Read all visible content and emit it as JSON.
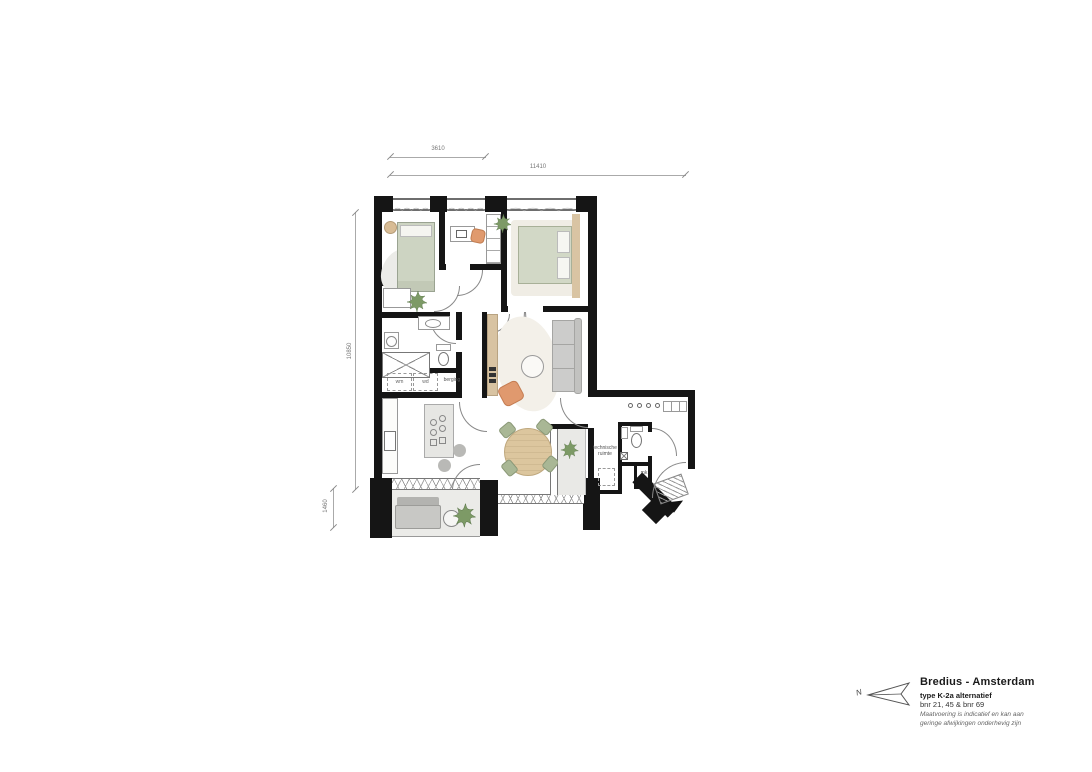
{
  "dimensions": {
    "top_inner": "3610",
    "top_outer": "11410",
    "left_outer": "10850",
    "left_lower": "1460"
  },
  "room_labels": {
    "storage": "berging",
    "washer": "wm",
    "dryer": "wd",
    "technical_line1": "technische",
    "technical_line2": "ruimte",
    "meter_closet": "mk"
  },
  "title_block": {
    "project": "Bredius - Amsterdam",
    "plan_type": "type K-2a alternatief",
    "units": "bnr 21, 45 & bnr 69",
    "disclaimer_line1": "Maatvoering is indicatief en kan aan",
    "disclaimer_line2": "geringe afwijkingen onderhevig zijn",
    "north_label": "N"
  },
  "colors": {
    "wall": "#151515",
    "wood": "#d8c3a2",
    "sage_bed": "#cdd4c2",
    "orange_chair": "#e0996e",
    "plant_green": "#7d9a66",
    "outdoor_floor": "#ebebe8",
    "gray_furniture": "#c8c8c5",
    "dim_line": "#aaaaaa"
  }
}
